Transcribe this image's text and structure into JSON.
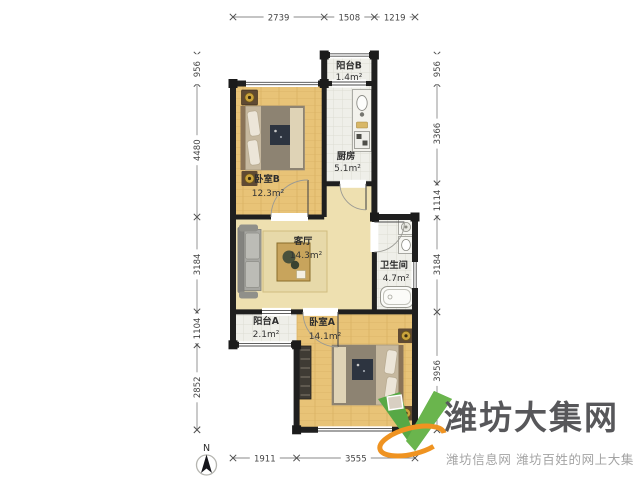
{
  "plan": {
    "rooms": [
      {
        "name": "阳台B",
        "area": "1.4m²"
      },
      {
        "name": "厨房",
        "area": "5.1m²"
      },
      {
        "name": "卧室B",
        "area": "12.3m²"
      },
      {
        "name": "客厅",
        "area": "14.3m²"
      },
      {
        "name": "卫生间",
        "area": "4.7m²"
      },
      {
        "name": "阳台A",
        "area": "2.1m²"
      },
      {
        "name": "卧室A",
        "area": "14.1m²"
      }
    ],
    "dimensions": {
      "top": [
        "2739",
        "1508",
        "1219"
      ],
      "bottom": [
        "1911",
        "3555"
      ],
      "left": [
        "956",
        "4480",
        "3184",
        "1104",
        "2852"
      ],
      "right": [
        "956",
        "3366",
        "1114",
        "3184",
        "3956"
      ]
    },
    "compass": {
      "label": "N"
    }
  },
  "watermark": {
    "brand": "潍坊大集网",
    "tagline": "潍坊信息网 潍坊百姓的网上大集"
  },
  "colors": {
    "wall": "#1f1f1f",
    "wood_floor": "#e8c377",
    "living_floor": "#eee0b0",
    "tile_floor": "#efefe9",
    "brand_green": "#57a845",
    "brand_orange": "#ef9321",
    "brand_text": "#57575a",
    "tagline_text": "#a3a3a3"
  }
}
